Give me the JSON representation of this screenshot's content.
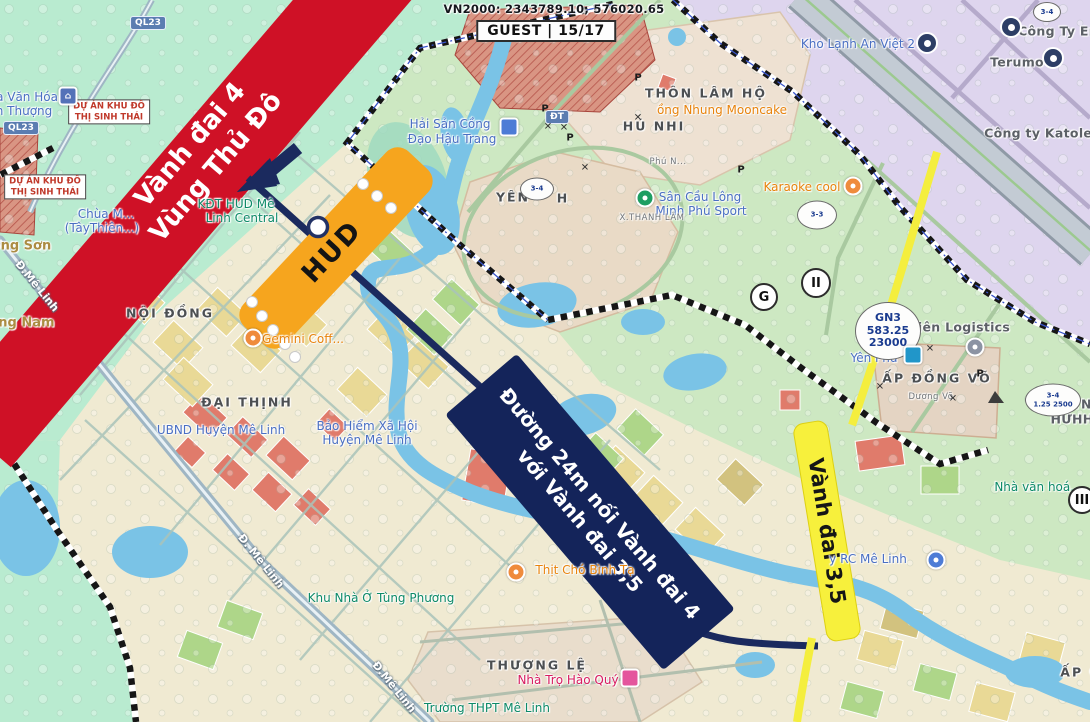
{
  "header": {
    "vn2000": "VN2000: 2343789.10, 576020.65",
    "guest": "GUEST | 15/17"
  },
  "overlays": {
    "ring_road_4": {
      "line1": "Vành đai 4",
      "line2": "Vùng Thủ Đô",
      "color": "#cf1126"
    },
    "hud": {
      "label": "HUD",
      "color": "#f6a51e"
    },
    "connector_road": {
      "line1": "Đường 24m nối Vành đai 4",
      "line2": "với Vành đai 3,5",
      "color": "#14245a"
    },
    "ring_road_35": {
      "label": "Vành đai 3,5",
      "color": "#f7f03c"
    }
  },
  "map": {
    "labels": [
      {
        "name": "kho-lanh-an-viet-2",
        "text": "Kho Lạnh An Việt 2",
        "x": 858,
        "y": 44,
        "rot": 0,
        "cls": "poi-blue"
      },
      {
        "name": "cong-ty-en",
        "text": "Công Ty En",
        "x": 1058,
        "y": 31,
        "rot": 0,
        "cls": "gray"
      },
      {
        "name": "terumo",
        "text": "Terumo",
        "x": 1017,
        "y": 62,
        "rot": 0,
        "cls": "gray"
      },
      {
        "name": "cong-ty-katolec",
        "text": "Công ty Katolec",
        "x": 1042,
        "y": 133,
        "rot": 0,
        "cls": "gray"
      },
      {
        "name": "thon-lam-ho",
        "text": "THÔN LÂM HỘ",
        "x": 706,
        "y": 93,
        "rot": 0,
        "cls": "area"
      },
      {
        "name": "nhung-mooncake",
        "text": "ồng Nhung Mooncake",
        "x": 722,
        "y": 110,
        "rot": 0,
        "cls": "poi-orange"
      },
      {
        "name": "phu-nhi",
        "text": "HÚ NHI",
        "x": 654,
        "y": 126,
        "rot": 0,
        "cls": "area"
      },
      {
        "name": "hai-san-1",
        "text": "Hải Sản Cồng",
        "x": 450,
        "y": 124,
        "rot": 0,
        "cls": "poi-blue"
      },
      {
        "name": "hai-san-2",
        "text": "Đạo Hậu Trang",
        "x": 452,
        "y": 139,
        "rot": 0,
        "cls": "poi-blue"
      },
      {
        "name": "nha-van-hoa-1",
        "text": "à Văn Hóa",
        "x": 27,
        "y": 97,
        "rot": 0,
        "cls": "poi-blue"
      },
      {
        "name": "nha-van-hoa-2",
        "text": "n Thượng",
        "x": 24,
        "y": 111,
        "rot": 0,
        "cls": "poi-blue"
      },
      {
        "name": "chua-1",
        "text": "Chùa M...",
        "x": 106,
        "y": 214,
        "rot": 0,
        "cls": "poi-blue"
      },
      {
        "name": "chua-2",
        "text": "(TâyThiên...)",
        "x": 102,
        "y": 228,
        "rot": 0,
        "cls": "poi-blue"
      },
      {
        "name": "hong-son",
        "text": "Hồng Sơn",
        "x": 16,
        "y": 246,
        "rot": 0,
        "cls": "tan"
      },
      {
        "name": "ang-nam",
        "text": "ang Nam",
        "x": 22,
        "y": 323,
        "rot": 0,
        "cls": "tan"
      },
      {
        "name": "d-me-linh-1",
        "text": "Đ.Mê Linh",
        "x": 37,
        "y": 286,
        "rot": 51,
        "cls": "road"
      },
      {
        "name": "noi-dong",
        "text": "NỘI ĐỒNG",
        "x": 170,
        "y": 313,
        "rot": 0,
        "cls": "area"
      },
      {
        "name": "hud-centre-1",
        "text": "KĐT HUD Mê",
        "x": 236,
        "y": 204,
        "rot": 0,
        "cls": "poi-teal"
      },
      {
        "name": "hud-centre-2",
        "text": "Linh Central",
        "x": 242,
        "y": 218,
        "rot": 0,
        "cls": "poi-teal"
      },
      {
        "name": "gemini-coffee",
        "text": "Gemini Coff...",
        "x": 303,
        "y": 339,
        "rot": 0,
        "cls": "poi-orange"
      },
      {
        "name": "dai-thinh",
        "text": "ĐẠI THỊNH",
        "x": 247,
        "y": 402,
        "rot": 0,
        "cls": "area"
      },
      {
        "name": "ubnd-huyen-me-linh",
        "text": "UBND Huyện Mê Linh",
        "x": 221,
        "y": 430,
        "rot": 0,
        "cls": "poi-blue"
      },
      {
        "name": "bao-hiem-1",
        "text": "Bảo Hiểm Xã Hội",
        "x": 367,
        "y": 426,
        "rot": 0,
        "cls": "poi-blue"
      },
      {
        "name": "bao-hiem-2",
        "text": "Huyện Mê Linh",
        "x": 367,
        "y": 440,
        "rot": 0,
        "cls": "poi-blue"
      },
      {
        "name": "d-me-linh-2",
        "text": "Đ. Mê Linh",
        "x": 261,
        "y": 561,
        "rot": 51,
        "cls": "road"
      },
      {
        "name": "tung-phuong",
        "text": "Khu Nhà Ở Tùng Phương",
        "x": 381,
        "y": 598,
        "rot": 0,
        "cls": "poi-teal"
      },
      {
        "name": "d-me-linh-3",
        "text": "Đ.Mê Linh",
        "x": 394,
        "y": 687,
        "rot": 51,
        "cls": "road"
      },
      {
        "name": "thuong-le",
        "text": "THƯỢNG LỆ",
        "x": 537,
        "y": 665,
        "rot": 0,
        "cls": "area"
      },
      {
        "name": "nha-tro-hao-quy",
        "text": "Nhà Trọ Hào Quý",
        "x": 568,
        "y": 680,
        "rot": 0,
        "cls": "poi-pink"
      },
      {
        "name": "truong-thpt-me-linh",
        "text": "Trường THPT Mê Linh",
        "x": 487,
        "y": 708,
        "rot": 0,
        "cls": "poi-teal"
      },
      {
        "name": "yen-1",
        "text": "YÊN",
        "x": 513,
        "y": 197,
        "rot": 0,
        "cls": "area"
      },
      {
        "name": "yen-2",
        "text": "H",
        "x": 563,
        "y": 198,
        "rot": 0,
        "cls": "area"
      },
      {
        "name": "phu-n",
        "text": "Phú N...",
        "x": 668,
        "y": 162,
        "rot": 0,
        "cls": "tiny"
      },
      {
        "name": "san-cau-long-1",
        "text": "Sân Cầu Lông",
        "x": 700,
        "y": 197,
        "rot": 0,
        "cls": "poi-blue"
      },
      {
        "name": "san-cau-long-2",
        "text": "Minh Phú Sport",
        "x": 701,
        "y": 211,
        "rot": 0,
        "cls": "poi-blue"
      },
      {
        "name": "karaoke-cool",
        "text": "Karaoke cool",
        "x": 802,
        "y": 187,
        "rot": 0,
        "cls": "poi-orange"
      },
      {
        "name": "xa-thanh-lam",
        "text": "X.THANH LÂM",
        "x": 652,
        "y": 218,
        "rot": 0,
        "cls": "tiny"
      },
      {
        "name": "thien-logistics",
        "text": "Thiên Logistics",
        "x": 955,
        "y": 327,
        "rot": 0,
        "cls": "gray"
      },
      {
        "name": "yen-phu",
        "text": "Yên Phủ",
        "x": 874,
        "y": 358,
        "rot": 0,
        "cls": "poi-blue"
      },
      {
        "name": "ap-dong-vo",
        "text": "ẤP ĐỒNG VÕ",
        "x": 937,
        "y": 378,
        "rot": 0,
        "cls": "area"
      },
      {
        "name": "duong-vo",
        "text": "Dương Võ",
        "x": 931,
        "y": 397,
        "rot": 0,
        "cls": "tiny"
      },
      {
        "name": "y-tn",
        "text": "Y TN",
        "x": 1075,
        "y": 404,
        "rot": 0,
        "cls": "gray"
      },
      {
        "name": "huhh",
        "text": "HƯHH",
        "x": 1072,
        "y": 419,
        "rot": 0,
        "cls": "gray"
      },
      {
        "name": "nha-van-hoa-3",
        "text": "Nhà văn hoá...",
        "x": 1038,
        "y": 487,
        "rot": 0,
        "cls": "poi-teal"
      },
      {
        "name": "rc-me-linh",
        "text": "y RC Mê Linh",
        "x": 868,
        "y": 559,
        "rot": 0,
        "cls": "poi-blue"
      },
      {
        "name": "thit-cho-binh-ta",
        "text": "Thịt Chó Bình Tạ",
        "x": 585,
        "y": 570,
        "rot": 0,
        "cls": "poi-orange"
      },
      {
        "name": "ap-g",
        "text": "ẤP G",
        "x": 1081,
        "y": 672,
        "rot": 0,
        "cls": "area"
      }
    ],
    "badges": [
      {
        "name": "ql23-badge-a",
        "text": "QL23",
        "x": 148,
        "y": 23
      },
      {
        "name": "ql23-badge-b",
        "text": "QL23",
        "x": 21,
        "y": 128
      },
      {
        "name": "dt-badge",
        "text": "ĐT",
        "x": 557,
        "y": 117
      }
    ],
    "boxes": [
      {
        "name": "du-an-sinh-thai-a",
        "lines": [
          "DỰ ÁN KHU ĐÔ",
          "THỊ SINH THÁI"
        ],
        "x": 109,
        "y": 112
      },
      {
        "name": "du-an-sinh-thai-b",
        "lines": [
          "DỰ ÁN KHU ĐÔ",
          "THỊ SINH THÁI"
        ],
        "x": 45,
        "y": 187
      }
    ],
    "circle_markers": [
      {
        "name": "zone-g-marker",
        "text": "G",
        "x": 764,
        "y": 297,
        "r": 12
      },
      {
        "name": "zone-ii-marker",
        "text": "II",
        "x": 816,
        "y": 283,
        "r": 13
      },
      {
        "name": "zone-iii-marker",
        "text": "III",
        "x": 1082,
        "y": 500,
        "r": 12
      }
    ],
    "ellipse_markers": [
      {
        "name": "plot-3-4-yen",
        "lines": [
          "3-4"
        ],
        "x": 537,
        "y": 189,
        "w": 32,
        "h": 21,
        "big": false
      },
      {
        "name": "plot-3-3",
        "lines": [
          "3-3"
        ],
        "x": 817,
        "y": 215,
        "w": 38,
        "h": 27,
        "big": false
      },
      {
        "name": "plot-gn3",
        "lines": [
          "GN3",
          "583.25",
          "23000"
        ],
        "x": 888,
        "y": 331,
        "w": 64,
        "h": 56,
        "big": true
      },
      {
        "name": "plot-3-4-east",
        "lines": [
          "3-4",
          "1.25 2500"
        ],
        "x": 1053,
        "y": 400,
        "w": 54,
        "h": 31,
        "big": false
      },
      {
        "name": "plot-3-4-top",
        "lines": [
          "3-4"
        ],
        "x": 1047,
        "y": 12,
        "w": 26,
        "h": 18,
        "big": false
      }
    ],
    "pois": [
      {
        "name": "community-house-icon",
        "shape": "square",
        "color": "#5472b8",
        "x": 68,
        "y": 96,
        "glyph": "⌂"
      },
      {
        "name": "seafood-marker-icon",
        "shape": "square",
        "color": "#4d7cd6",
        "x": 509,
        "y": 127,
        "glyph": ""
      },
      {
        "name": "badminton-icon",
        "shape": "circle",
        "color": "#1e9e62",
        "x": 645,
        "y": 198,
        "glyph": ""
      },
      {
        "name": "karaoke-icon",
        "shape": "circle",
        "color": "#ef8b3c",
        "x": 853,
        "y": 186,
        "glyph": ""
      },
      {
        "name": "restaurant-icon",
        "shape": "circle",
        "color": "#ef8b3c",
        "x": 516,
        "y": 572,
        "glyph": ""
      },
      {
        "name": "coffee-icon",
        "shape": "circle",
        "color": "#ef8b3c",
        "x": 253,
        "y": 338,
        "glyph": ""
      },
      {
        "name": "logistics-icon",
        "shape": "circle",
        "color": "#8b93a3",
        "x": 975,
        "y": 347,
        "glyph": ""
      },
      {
        "name": "yen-phu-marker-icon",
        "shape": "square",
        "color": "#2196c9",
        "x": 913,
        "y": 355,
        "glyph": ""
      },
      {
        "name": "hostel-icon",
        "shape": "square",
        "color": "#e4559d",
        "x": 630,
        "y": 678,
        "glyph": ""
      },
      {
        "name": "factory-icon-1",
        "shape": "donut",
        "color": "#2d3e66",
        "x": 1011,
        "y": 27,
        "glyph": ""
      },
      {
        "name": "factory-icon-2",
        "shape": "donut",
        "color": "#2d3e66",
        "x": 1053,
        "y": 58,
        "glyph": ""
      },
      {
        "name": "factory-icon-3",
        "shape": "donut",
        "color": "#2d3e66",
        "x": 927,
        "y": 43,
        "glyph": ""
      },
      {
        "name": "rc-me-linh-icon",
        "shape": "circle",
        "color": "#4d7cd6",
        "x": 936,
        "y": 560,
        "glyph": ""
      }
    ],
    "x_marks": [
      {
        "x": 548,
        "y": 127
      },
      {
        "x": 564,
        "y": 128
      },
      {
        "x": 638,
        "y": 118
      },
      {
        "x": 585,
        "y": 168
      },
      {
        "x": 930,
        "y": 349
      },
      {
        "x": 953,
        "y": 399
      },
      {
        "x": 880,
        "y": 387
      }
    ],
    "p_marks": [
      {
        "x": 545,
        "y": 109
      },
      {
        "x": 570,
        "y": 138
      },
      {
        "x": 741,
        "y": 170
      },
      {
        "x": 980,
        "y": 374
      },
      {
        "x": 638,
        "y": 78
      }
    ]
  }
}
